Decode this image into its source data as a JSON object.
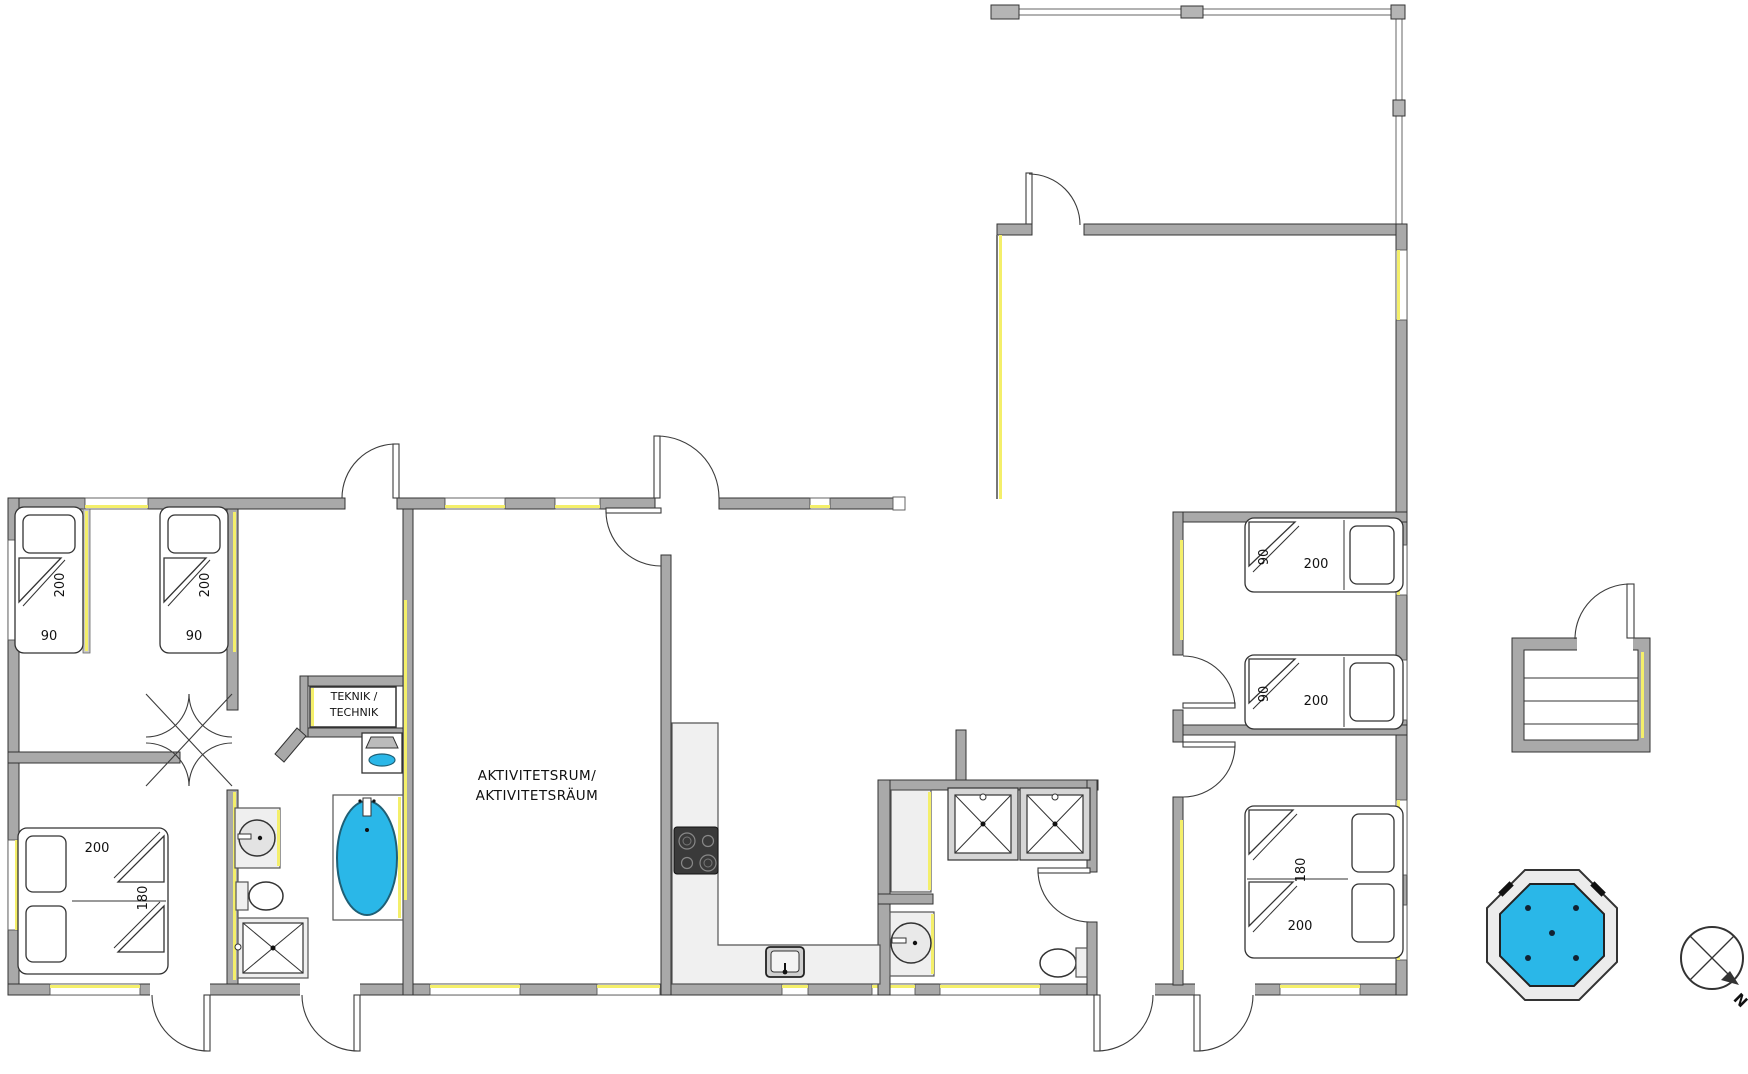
{
  "colors": {
    "wall_gray": "#a9a9a9",
    "outline": "#333333",
    "window_yellow": "#f4ef6a",
    "water_cyan": "#2ab7e8",
    "appliance_dark": "#3a3a3a",
    "counter_gray": "#f0f0f0"
  },
  "rooms": {
    "teknik": {
      "line1": "TEKNIK /",
      "line2": "TECHNIK"
    },
    "activity": {
      "line1": "AKTIVITETSRUM/",
      "line2": "AKTIVITETSRÄUM"
    }
  },
  "beds": [
    {
      "id": "single-left-1",
      "width_label": "90",
      "length_label": "200"
    },
    {
      "id": "single-left-2",
      "width_label": "90",
      "length_label": "200"
    },
    {
      "id": "double-left",
      "width_label": "180",
      "length_label": "200"
    },
    {
      "id": "single-right-1",
      "width_label": "90",
      "length_label": "200"
    },
    {
      "id": "single-right-2",
      "width_label": "90",
      "length_label": "200"
    },
    {
      "id": "double-right",
      "width_label": "180",
      "length_label": "200"
    }
  ],
  "compass": {
    "north_label": "N"
  }
}
